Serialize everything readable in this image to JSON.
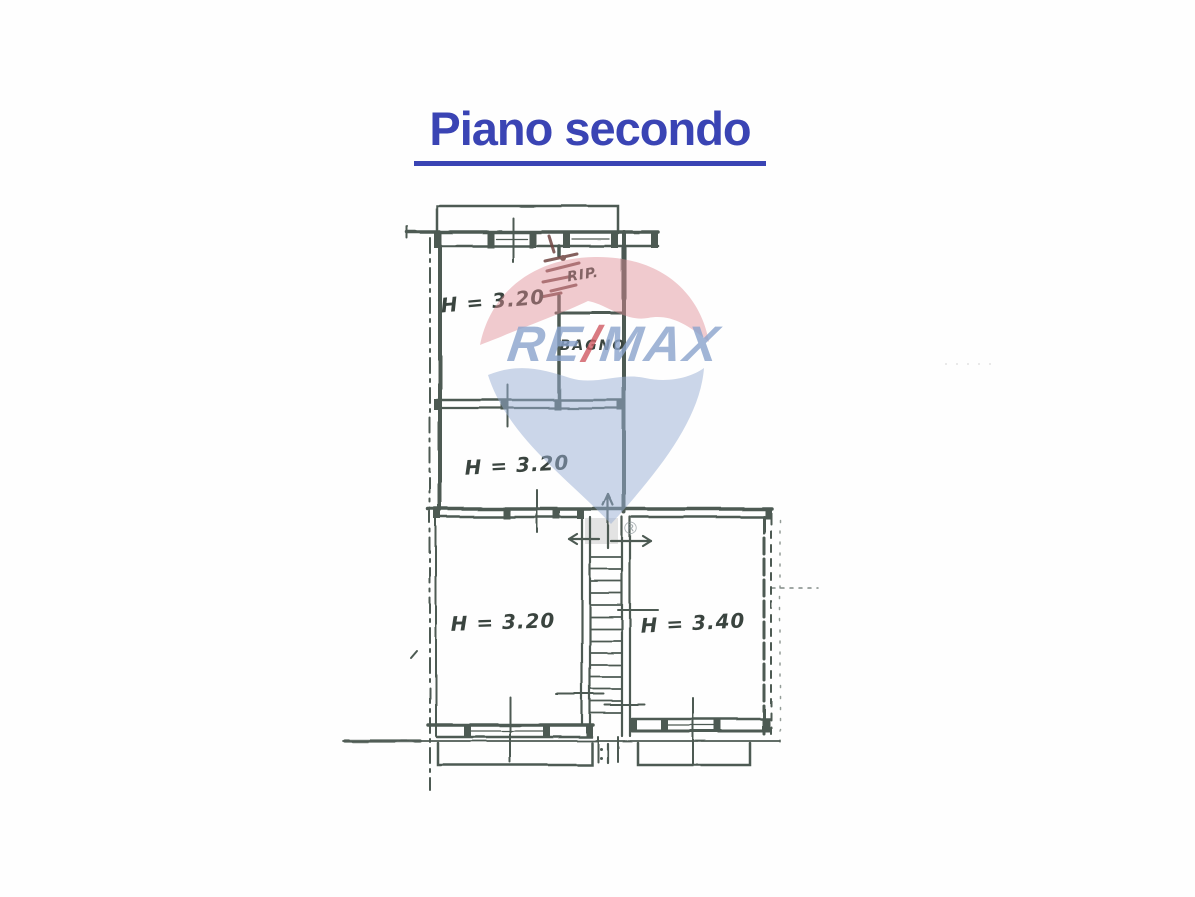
{
  "page": {
    "title": "Piano secondo"
  },
  "floor_plan": {
    "rooms": [
      {
        "id": "room-top-left",
        "label": "H = 3.20"
      },
      {
        "id": "closet",
        "label": "RIP."
      },
      {
        "id": "bathroom",
        "label": "BAGNO"
      },
      {
        "id": "room-middle",
        "label": "H = 3.20"
      },
      {
        "id": "room-lower-left",
        "label": "H = 3.20"
      },
      {
        "id": "room-lower-right",
        "label": "H = 3.40"
      }
    ]
  },
  "watermark": {
    "brand_re": "RE",
    "brand_slash": "/",
    "brand_max": "MAX",
    "registered": "®"
  },
  "colors": {
    "title_blue": "#3a44b4",
    "plan_ink": "#4d5a52",
    "watermark_red": "#e18b95",
    "watermark_blue": "#97aed3",
    "watermark_text_blue": "#8ba4cd",
    "watermark_slash_red": "#d05a63"
  }
}
